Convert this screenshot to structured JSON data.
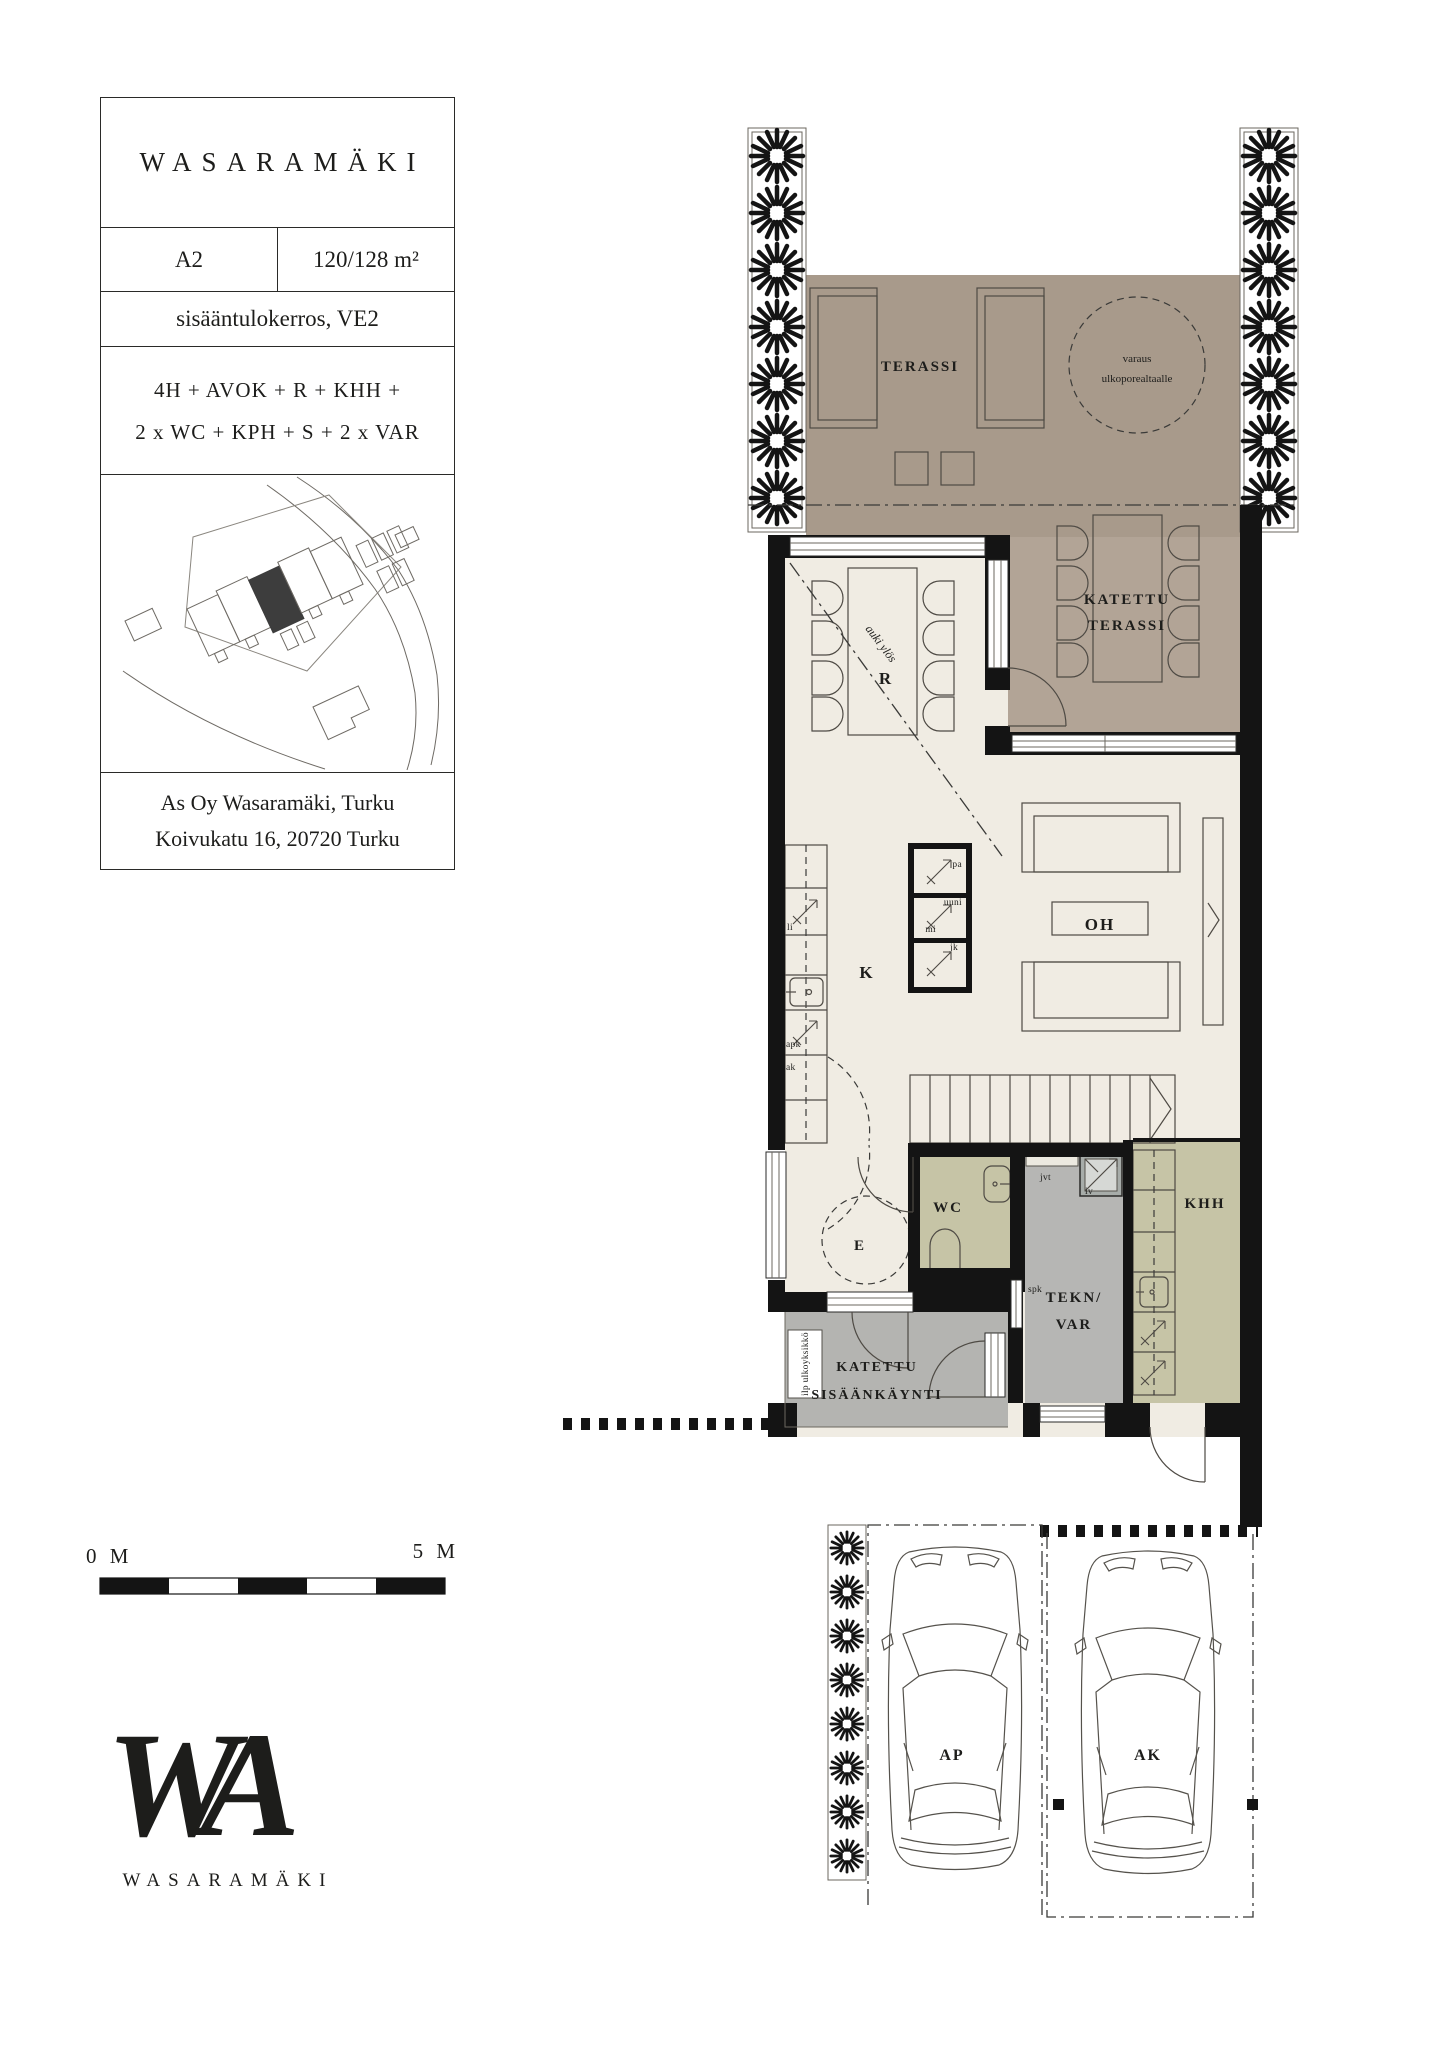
{
  "info": {
    "title": "WASARAMÄKI",
    "unit": "A2",
    "area": "120/128 m²",
    "floor": "sisääntulokerros, VE2",
    "program_line1": "4H + AVOK + R + KHH +",
    "program_line2": "2 x WC + KPH + S + 2 x VAR",
    "address_line1": "As Oy Wasaramäki, Turku",
    "address_line2": "Koivukatu 16, 20720 Turku"
  },
  "plan": {
    "terassi": "TERASSI",
    "katettu_line1": "KATETTU",
    "katettu_line2": "TERASSI",
    "varaus_line1": "varaus",
    "varaus_line2": "ulkoporealtaalle",
    "dining": "R",
    "auki_ylos": "auki ylös",
    "kitchen": "K",
    "living": "OH",
    "hall": "E",
    "wc": "WC",
    "tekn_line1": "TEKN/",
    "tekn_line2": "VAR",
    "khh": "KHH",
    "entry_line1": "KATETTU",
    "entry_line2": "SISÄÄNKÄYNTI",
    "ilp": "ilp ulkoyksikkö",
    "jvt": "jvt",
    "iv": "iv",
    "spk": "spk",
    "li": "li",
    "apk": "apk",
    "ak": "ak",
    "pa": "pa",
    "uuni": "uuni",
    "mi": "mi",
    "jk": "jk"
  },
  "parking": {
    "ap": "AP",
    "ak": "AK"
  },
  "scalebar": {
    "zero": "0 M",
    "five": "5 M"
  },
  "logo": {
    "monogram": "WA",
    "wordmark": "WASARAMÄKI"
  },
  "colors": {
    "terrace": "#a89a8b",
    "covered": "#b2a496",
    "interior": "#f0ece3",
    "olive": "#c6c4a6",
    "tech_gray": "#b6b6b4",
    "porch_gray": "#b4b4b1",
    "wall": "#141414",
    "ink": "#1d1d1b"
  }
}
